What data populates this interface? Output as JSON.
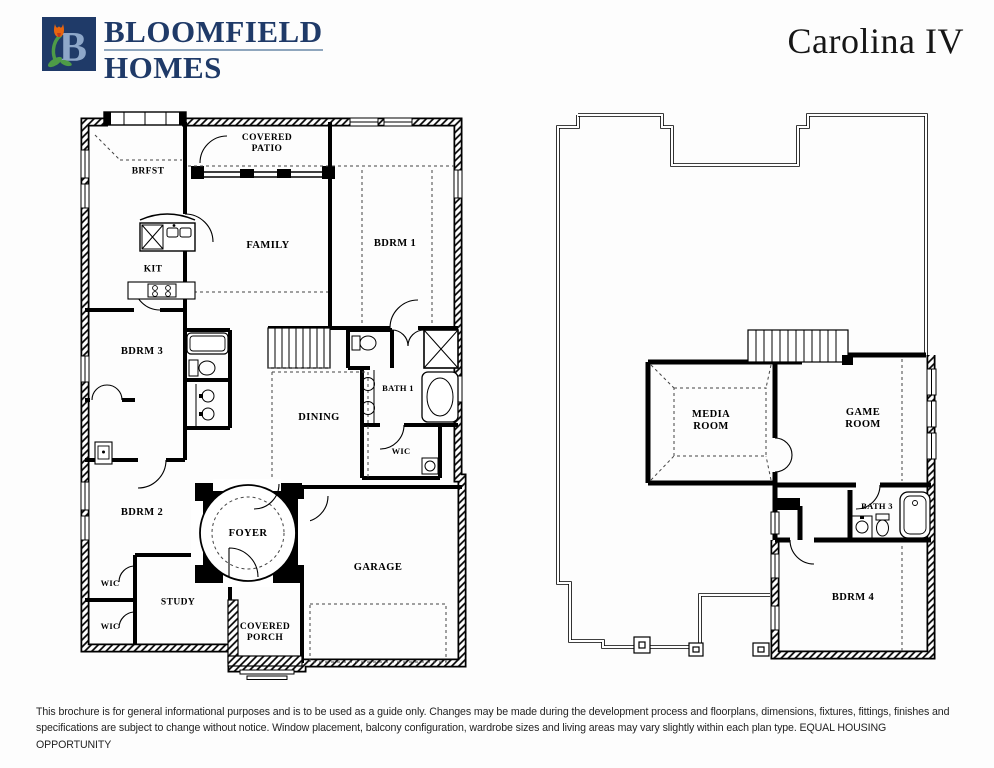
{
  "brand": {
    "line1": "BLOOMFIELD",
    "line2": "HOMES",
    "logo_letter": "B"
  },
  "title": "Carolina IV",
  "colors": {
    "brand_navy": "#1f3a68",
    "logo_letter_blue": "#8ea7c9",
    "logo_leaf_green": "#4e9b47",
    "logo_tulip_orange": "#e8650f",
    "ink": "#000000"
  },
  "floor1": {
    "labels": {
      "brfst": "BRFST",
      "covered_patio": "COVERED\nPATIO",
      "family": "FAMILY",
      "bdrm1": "BDRM 1",
      "kit": "KIT",
      "bdrm3": "BDRM 3",
      "bath1": "BATH 1",
      "dining": "DINING",
      "wic_bath": "WIC",
      "bdrm2": "BDRM 2",
      "foyer": "FOYER",
      "garage": "GARAGE",
      "wic_upper": "WIC",
      "study": "STUDY",
      "wic_lower": "WIC",
      "covered_porch": "COVERED\nPORCH"
    }
  },
  "floor2": {
    "labels": {
      "media_room": "MEDIA\nROOM",
      "game_room": "GAME\nROOM",
      "bath3": "BATH 3",
      "bdrm4": "BDRM 4"
    }
  },
  "footer": {
    "disclaimer": "This brochure is for general informational purposes and is to be used as a guide only. Changes may be made during the development process and floorplans, dimensions, fixtures, fittings, finishes and specifications are subject to change without notice. Window placement, balcony configuration, wardrobe sizes and living areas may vary slightly within each plan type.  EQUAL HOUSING OPPORTUNITY"
  }
}
